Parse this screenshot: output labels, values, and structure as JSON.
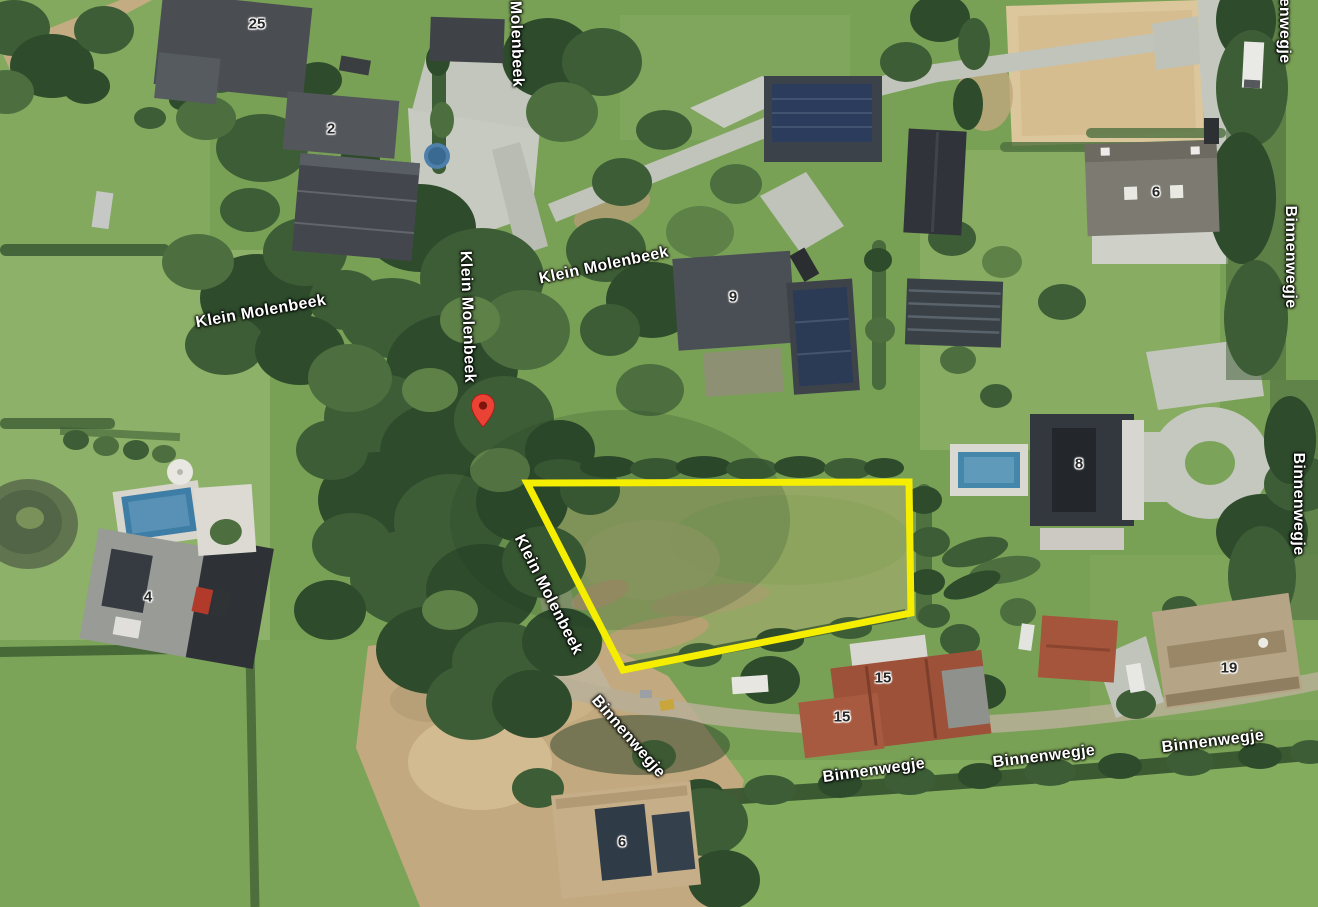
{
  "map": {
    "view": "satellite",
    "pin": {
      "x": 483,
      "y": 427,
      "color": "#EA4335",
      "dot_color": "#7E150C"
    },
    "parcel_outline": {
      "color": "#F6EE00",
      "stroke_width": 7,
      "points": [
        [
          527,
          483
        ],
        [
          909,
          482
        ],
        [
          911,
          613
        ],
        [
          623,
          670
        ]
      ]
    },
    "street_labels": [
      {
        "text": "Molenbeek",
        "x": 516,
        "y": 44,
        "rotation": 88
      },
      {
        "text": "Klein Molenbeek",
        "x": 261,
        "y": 312,
        "rotation": -10
      },
      {
        "text": "Klein Molenbeek",
        "x": 467,
        "y": 317,
        "rotation": 88
      },
      {
        "text": "Klein Molenbeek",
        "x": 604,
        "y": 266,
        "rotation": -12
      },
      {
        "text": "Klein Molenbeek",
        "x": 548,
        "y": 595,
        "rotation": 63
      },
      {
        "text": "Binnenwegje",
        "x": 1284,
        "y": 12,
        "rotation": 90
      },
      {
        "text": "Binnenwegje",
        "x": 1290,
        "y": 257,
        "rotation": 90
      },
      {
        "text": "Binnenwegje",
        "x": 1298,
        "y": 504,
        "rotation": 90
      },
      {
        "text": "Binnenwegje",
        "x": 628,
        "y": 737,
        "rotation": 49
      },
      {
        "text": "Binnenwegje",
        "x": 874,
        "y": 771,
        "rotation": -8
      },
      {
        "text": "Binnenwegje",
        "x": 1044,
        "y": 757,
        "rotation": -7
      },
      {
        "text": "Binnenwegje",
        "x": 1213,
        "y": 742,
        "rotation": -7
      }
    ],
    "house_numbers": [
      {
        "text": "25",
        "x": 257,
        "y": 24
      },
      {
        "text": "2",
        "x": 331,
        "y": 129
      },
      {
        "text": "9",
        "x": 733,
        "y": 297
      },
      {
        "text": "6",
        "x": 1156,
        "y": 192
      },
      {
        "text": "8",
        "x": 1079,
        "y": 464
      },
      {
        "text": "4",
        "x": 148,
        "y": 597
      },
      {
        "text": "15",
        "x": 883,
        "y": 678
      },
      {
        "text": "15",
        "x": 842,
        "y": 717
      },
      {
        "text": "19",
        "x": 1229,
        "y": 668
      },
      {
        "text": "6",
        "x": 622,
        "y": 842
      }
    ]
  }
}
